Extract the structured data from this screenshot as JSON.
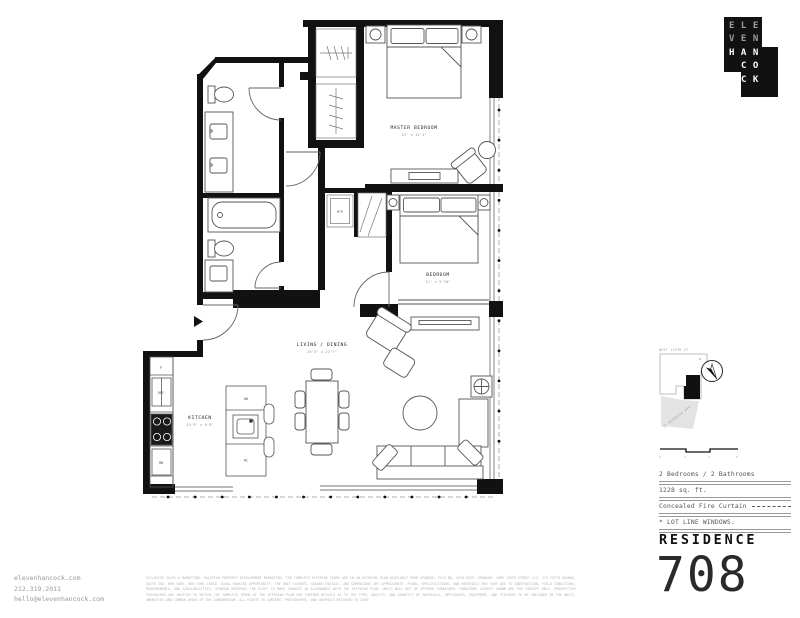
{
  "brand": {
    "logo_rows": [
      "ELE",
      "VEN",
      "HAN",
      "CO",
      "CK"
    ]
  },
  "residence": {
    "label": "RESIDENCE",
    "number": "708"
  },
  "specs": {
    "row1": "2 Bedrooms / 2 Bathrooms",
    "row2": "1228 sq. ft.",
    "row3": "Concealed Fire Curtain",
    "row4": "* LOT LINE WINDOWS."
  },
  "key_plan": {
    "street_top": "WEST 125TH ST",
    "street_diagonal": "ST NICHOLAS AVE",
    "compass_n": "N",
    "scale_ticks": [
      "0",
      "2",
      "4",
      "8"
    ]
  },
  "contact": {
    "website": "elevenhancock.com",
    "phone": "212.319.2011",
    "email": "hello@elevenhancock.com"
  },
  "plan": {
    "master_bedroom": {
      "name": "MASTER BEDROOM",
      "dims": "15' x 12'3\""
    },
    "bedroom": {
      "name": "BEDROOM",
      "dims": "11' x 9'10\""
    },
    "living_dining": {
      "name": "LIVING / DINING",
      "dims": "25'3\" x 21'7\""
    },
    "kitchen": {
      "name": "KITCHEN",
      "dims": "15'9\" x 9'8\""
    },
    "washer_dryer": "W/D",
    "pantry": "P",
    "refrigerator": "REF",
    "microwave": "MW",
    "dishwasher": "DW",
    "wine_cooler": "WC"
  },
  "disclaimer": {
    "text": "EXCLUSIVE SALES & MARKETING: HALSTEAD PROPERTY DEVELOPMENT MARKETING. THE COMPLETE OFFERING TERMS ARE IN AN OFFERING PLAN AVAILABLE FROM SPONSOR. FILE NO. CD18-0335. SPONSOR: CORE 125TH STREET LLC, 174 FIFTH AVENUE, SUITE 302, NEW YORK, NEW YORK 10010. EQUAL HOUSING OPPORTUNITY. THE UNIT LAYOUTS, SQUARE FOOTAGE, AND DIMENSIONS ARE APPROXIMATE. PLANS, SPECIFICATIONS, AND MATERIALS MAY VARY DUE TO CONSTRUCTION, FIELD CONDITIONS, REQUIREMENTS, AND AVAILABILITIES. SPONSOR RESERVES THE RIGHT TO MAKE CHANGES IN ACCORDANCE WITH THE OFFERING PLAN. UNITS WILL NOT BE OFFERED FURNISHED. FURNITURE LAYOUTS SHOWN ARE FOR CONCEPT ONLY. PROSPECTIVE PURCHASERS ARE ADVISED TO REVIEW THE COMPLETE TERMS OF THE OFFERING PLAN FOR FURTHER DETAILS AS TO THE TYPE, QUALITY, AND QUANTITY OF MATERIALS, APPLIANCES, EQUIPMENT, AND FIXTURES TO BE INCLUDED IN THE UNITS, AMENITIES AND COMMON AREAS OF THE CONDOMINIUM. ALL RIGHTS TO CONTENT, PHOTOGRAPHS, AND GRAPHICS RESERVED TO CORE."
  },
  "colors": {
    "ink": "#111111",
    "gray": "#8a8a8a",
    "light_gray": "#e3e3e3"
  }
}
